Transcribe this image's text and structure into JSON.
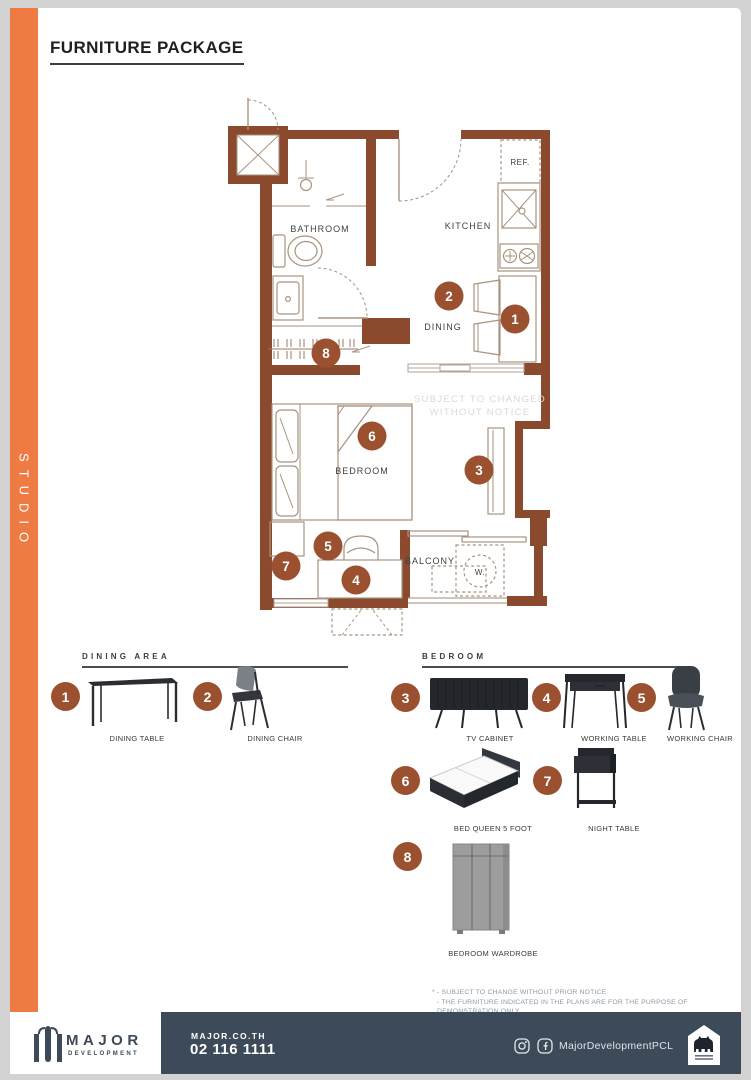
{
  "sidebar": {
    "unit_type": "STUDIO"
  },
  "header": {
    "title": "FURNITURE PACKAGE"
  },
  "plan": {
    "rooms": {
      "bathroom": "BATHROOM",
      "kitchen": "KITCHEN",
      "dining": "DINING",
      "bedroom": "BEDROOM",
      "balcony": "BALCONY"
    },
    "fixtures": {
      "refrigerator": "REF.",
      "washer": "W."
    },
    "watermark": {
      "line1": "SUBJECT TO CHANGED",
      "line2": "WITHOUT NOTICE"
    },
    "markers": [
      "1",
      "2",
      "3",
      "4",
      "5",
      "6",
      "7",
      "8"
    ]
  },
  "legend": {
    "sections": [
      {
        "title": "DINING AREA",
        "items": [
          {
            "num": "1",
            "label": "DINING TABLE"
          },
          {
            "num": "2",
            "label": "DINING CHAIR"
          }
        ]
      },
      {
        "title": "BEDROOM",
        "items": [
          {
            "num": "3",
            "label": "TV CABINET"
          },
          {
            "num": "4",
            "label": "WORKING TABLE"
          },
          {
            "num": "5",
            "label": "WORKING CHAIR"
          },
          {
            "num": "6",
            "label": "BED QUEEN 5 FOOT"
          },
          {
            "num": "7",
            "label": "NIGHT TABLE"
          },
          {
            "num": "8",
            "label": "BEDROOM WARDROBE"
          }
        ]
      }
    ]
  },
  "notes": {
    "line1": "* - SUBJECT TO CHANGE WITHOUT PRIOR NOTICE",
    "line2": "- THE FURNITURE INDICATED IN THE PLANS ARE FOR THE PURPOSE OF DEMONSTRATION ONLY."
  },
  "footer": {
    "brand": "MAJOR",
    "brand_subtitle": "DEVELOPMENT",
    "website": "MAJOR.CO.TH",
    "phone": "02 116 1111",
    "social_handle": "MajorDevelopmentPCL"
  },
  "colors": {
    "accent_orange": "#EE7B41",
    "wall_brown": "#8B4A2E",
    "marker_brown": "#9B5130",
    "footer_navy": "#3D4A59"
  }
}
